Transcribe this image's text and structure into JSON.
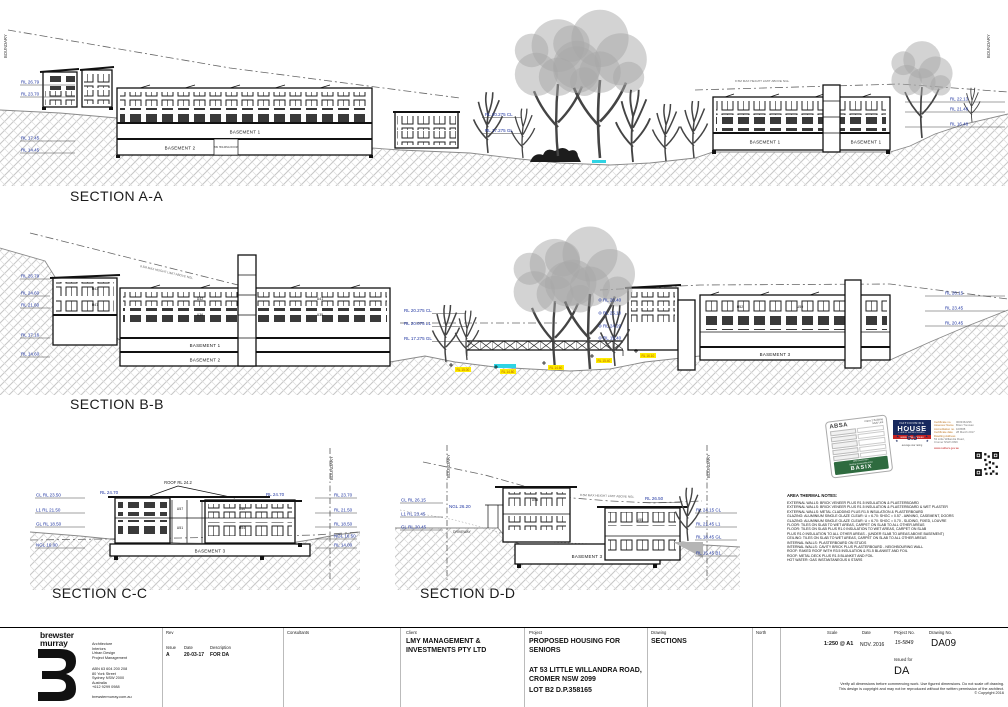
{
  "labels": {
    "section_a": "SECTION A-A",
    "section_b": "SECTION B-B",
    "section_c": "SECTION C-C",
    "section_d": "SECTION D-D",
    "boundary": "BOUNDARY",
    "height_limit": "8.5M MAX HEIGHT LIMIT ABOVE NGL",
    "basement1": "BASEMENT 1",
    "basement2": "BASEMENT 2",
    "basement3": "BASEMENT 3",
    "bin_room": "BIN HOLDING ROOM",
    "driveway": "DRIVEWAY",
    "roof_note": "ROOF RL 24.2"
  },
  "rls": {
    "a_left": [
      "RL 26.79",
      "RL 23.70",
      "RL 17.45",
      "RL 14.45"
    ],
    "a_mid": [
      "RL 20.275  CL",
      "RL 17.275  GL"
    ],
    "a_right": [
      "RL 22.13",
      "RL 21.48",
      "RL 16.48"
    ],
    "b_left": [
      "RL 26.79",
      "RL 24.60",
      "RL 21.60",
      "RL 17.16",
      "RL 14.60"
    ],
    "b_mid": [
      "RL 20.275  CL",
      "RL 20.075  L1",
      "RL 17.275  GL"
    ],
    "b_right": [
      "RL 26.40",
      "RL 25.10",
      "RL 24.20",
      "RL 19.40"
    ],
    "b_far_right": [
      "RL 26.15",
      "RL 23.45",
      "RL 20.45"
    ],
    "b_spots": [
      "RL 15.00",
      "RL 14.80",
      "RL 14.60",
      "RL 15.40",
      "RL 16.10"
    ],
    "c_left": [
      "CL  RL 23.50",
      "L1  RL 21.50",
      "GL  RL 18.50",
      "NGL 16.00"
    ],
    "c_right": [
      "RL 23.70",
      "RL 21.50",
      "RL 18.50",
      "NGL 16.50",
      "RL 14.00"
    ],
    "c_roof": "RL 24.70",
    "d_left": [
      "CL  RL 26.15",
      "L1  RL 23.45",
      "GL  RL 20.45"
    ],
    "d_ngl": "NGL 26.20",
    "d_mid": "RL 26.50",
    "d_right": [
      "RL 24.15  CL",
      "RL 21.45  L1",
      "RL 18.45  GL",
      "RL 15.45  B1"
    ]
  },
  "units": {
    "b": [
      "U43",
      "U47",
      "U42",
      "U41",
      "U36",
      "U35"
    ],
    "br": [
      "U52",
      "U50"
    ],
    "c": [
      "U57",
      "U51",
      "U50",
      "U54"
    ],
    "d": [
      "U58",
      "U55"
    ]
  },
  "notes": {
    "title": "AREA THERMAL NOTES:",
    "lines": [
      "EXTERNAL WALLS: BRICK VENEER PLUS R1.5 INSULATION & PLASTERBOARD",
      "EXTERNAL WALLS: BRICK VENEER PLUS R1.5 INSULATION & PLASTERBOARD & WET PLASTER",
      "EXTERNAL WALLS: METAL CLADDING PLUS R1.5 INSULATION & PLASTERBOARD",
      "GLAZING: ALUMINIUM SINGLE GLAZE CLEAR: U = 6.70: SHGC = 0.57 - AWNING, CASEMENT, DOORS",
      "GLAZING: ALUMINIUM SINGLE GLAZE CLEAR: U = 6.70: SHGC = 0.70 - SLIDING, FIXED, LOUVRE",
      "FLOOR: TILES ON SLAB TO WET AREAS, CARPET ON SLAB TO ALL OTHER AREAS",
      "FLOOR: TILES ON SLAB PLUS R1.0 INSULATION TO WET AREAS, CARPET ON SLAB",
      "        PLUS R1.0 INSULATION TO ALL OTHER AREAS - (UNDER SLAB TO AREAS ABOVE BASEMENT)",
      "CEILING: TILES ON SLAB TO WET AREAS, CARPET ON SLAB TO ALL OTHER AREAS",
      "INTERNAL WALLS: PLASTERBOARD ON STUDS",
      "INTERNAL WALLS: CAVITY BRICK PLUS PLASTERBOARD - NEIGHBOURING WALL",
      "ROOF: RAKED ROOF WITH R3.5 INSULATION & R1.5 BLANKET AND FOIL",
      "ROOF: METAL DECK PLUS R1.5 BLANKET AND FOIL",
      "HOT WATER: GAS INSTANTANEOUS 6 STARS"
    ]
  },
  "stamps": {
    "absa": {
      "brand": "ABSA",
      "type1": "Class 2 Building",
      "type2": "Multi Unit",
      "footer1": "NSW Government",
      "footer2": "Building Sustainability Index",
      "basix": "BASIX"
    },
    "nathers": {
      "rating": "6.5",
      "caption": "average star rating",
      "name1": "NATIONWIDE",
      "name2": "HOUSE",
      "name3": "ENERGY RATING SCHEME",
      "band": "www.nathers.gov.au",
      "url": "www.nathers.gov.au",
      "fields": [
        {
          "label": "Certificate no.",
          "value": "0003362296"
        },
        {
          "label": "Assessor Name",
          "value": "Brian Trevisan"
        },
        {
          "label": "Accreditation no.",
          "value": "100588"
        },
        {
          "label": "Certificate date",
          "value": "28 March 2017"
        },
        {
          "label": "Dwelling Address",
          "value": "53 Little Willandra Road, Cromer NSW 2099"
        }
      ]
    }
  },
  "tb": {
    "firm": {
      "name1": "brewster",
      "name2": "murray",
      "services": [
        "Architecture",
        "Interiors",
        "Urban Design",
        "Project Management"
      ],
      "info": [
        "ABN 63 604 200 208",
        "80 York Street",
        "Sydney NSW 2000",
        "Australia",
        "+612 9299 0988"
      ],
      "website": "brewstermurray.com.au"
    },
    "rev": {
      "label": "Rev",
      "cols": [
        "Issue",
        "Date",
        "Description"
      ],
      "row": [
        "A",
        "20-03-17",
        "FOR DA"
      ]
    },
    "consultants_label": "Consultants",
    "client": {
      "label": "Client",
      "value": "LMY MANAGEMENT & INVESTMENTS PTY LTD"
    },
    "project": {
      "label": "Project",
      "title": "PROPOSED HOUSING FOR SENIORS",
      "address": "AT 53 LITTLE WILLANDRA ROAD, CROMER NSW 2099",
      "lot": "LOT B2 D.P.358165"
    },
    "drawing": {
      "label": "Drawing",
      "value": "SECTIONS"
    },
    "north_label": "North",
    "scale": {
      "label": "Scale",
      "value": "1:250 @ A1"
    },
    "date": {
      "label": "Date",
      "value": "NOV. 2016"
    },
    "project_no": {
      "label": "Project No.",
      "value": "15-5849"
    },
    "drawing_no": {
      "label": "Drawing No.",
      "value": "DA09"
    },
    "issued_for": {
      "label": "Issued for",
      "value": "DA"
    },
    "disclaimer": [
      "Verify all dimensions before commencing work. Use figured dimensions. Do not scale off drawing.",
      "This design is copyright and may not be reproduced without the written permission of the architect.",
      "© Copyright 2016"
    ]
  }
}
